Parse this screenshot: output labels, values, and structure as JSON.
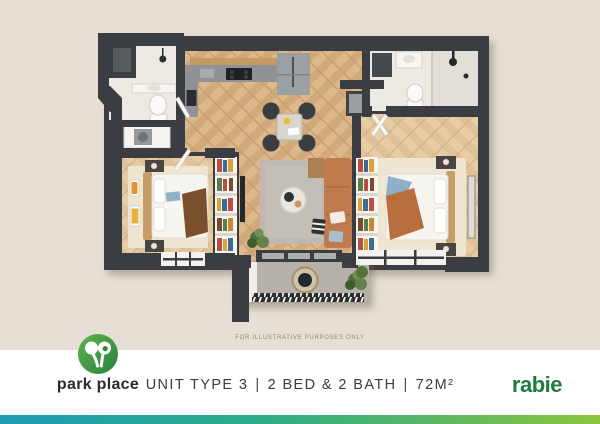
{
  "disclaimer": "FOR ILLUSTRATIVE PURPOSES ONLY",
  "caption": {
    "unit": "UNIT TYPE 3",
    "separator": "|",
    "beds_baths": "2 BED & 2 BATH",
    "area": "72M²"
  },
  "brand_left": {
    "name": "park place"
  },
  "brand_right": {
    "name": "rabie"
  },
  "colors": {
    "background_beige": "#e7dfd5",
    "wall_charcoal": "#3a3e42",
    "wood_floor": "#d8b285",
    "sofa_terracotta": "#bf7a4e",
    "logo_green_light": "#5fb24c",
    "logo_green_dark": "#28833c",
    "rabie_green": "#1d7c3e",
    "gradient_bar_left": "#1f9ab3",
    "gradient_bar_mid": "#2fae85",
    "gradient_bar_right": "#8cc63f"
  },
  "floor_plan": {
    "kind": "apartment-top-view-render",
    "rooms": [
      "kitchen-dining",
      "bathroom",
      "ensuite-bathroom",
      "bedroom",
      "main-bedroom",
      "living-room",
      "balcony",
      "entry"
    ]
  }
}
